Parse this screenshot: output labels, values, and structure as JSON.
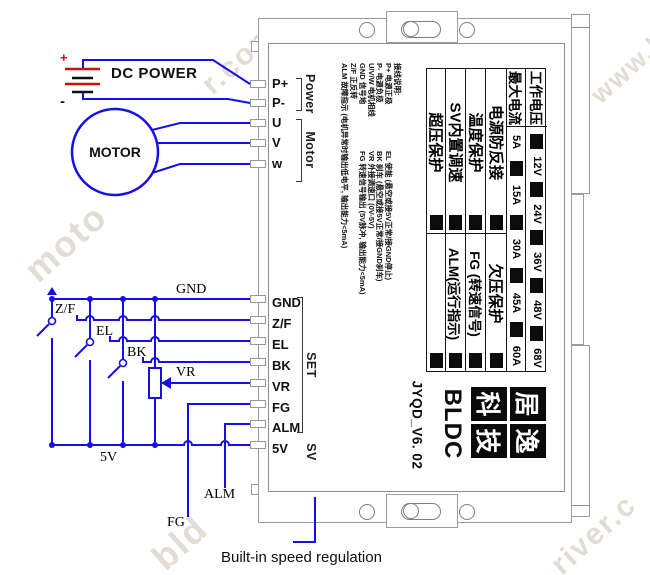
{
  "left_circuit": {
    "dc_power": "DC POWER",
    "plus": "+",
    "minus": "-",
    "motor": "MOTOR",
    "gnd": "GND",
    "five_v": "5V",
    "zf": "Z/F",
    "el": "EL",
    "bk": "BK",
    "vr": "VR",
    "fg": "FG",
    "alm": "ALM",
    "caption": "Built-in speed regulation"
  },
  "board": {
    "power_pins": [
      "P+",
      "P-",
      "U",
      "V",
      "w"
    ],
    "power_group": "Power",
    "motor_group": "Motor",
    "set_pins": [
      "GND",
      "Z/F",
      "EL",
      "BK",
      "VR",
      "FG",
      "ALM",
      "5V"
    ],
    "set_group": "SET",
    "sv_group": "SV",
    "notes": {
      "title": "接线说明:",
      "rows": [
        {
          "left": "P+ 电源正极",
          "right": "EL 使能 (悬空或接5V正常/接GND停止)"
        },
        {
          "left": "P- 电源负极",
          "right": "BK 刹车 (悬空或接5V正常/接GND刹车)"
        },
        {
          "left": "U/V/W 电机相线",
          "right": "VR 外接调速口 (0V-5V)"
        },
        {
          "left": "GND 信号地",
          "right": "FG 转速信号输出 (5V脉冲, 输出能力<5mA)"
        },
        {
          "left": "Z/F 正反转",
          "right": ""
        },
        {
          "left": "ALM 故障指示 (电机异常时输出低电平, 输出能力<5mA)",
          "right": ""
        }
      ]
    },
    "spec_table": {
      "voltage_header": "工作电压",
      "voltages": [
        "12V",
        "24V",
        "36V",
        "48V",
        "68V"
      ],
      "current_header": "最大电流",
      "currents": [
        "5A",
        "15A",
        "30A",
        "45A",
        "60A"
      ],
      "features_top": [
        "超压保护",
        "SV内置调速",
        "温度保护",
        "电源防反接"
      ],
      "features_bottom": [
        "",
        "ALM(运行指示)",
        "FG (转速信号)",
        "欠压保护"
      ]
    },
    "logo": {
      "model": "JYQD_V6. 02",
      "series": "BLDC",
      "brand": [
        "居",
        "逸",
        "科",
        "技"
      ]
    }
  },
  "colors": {
    "wire_blue": "#1511e6",
    "battery_red": "#cc1111"
  },
  "watermarks": [
    "moto",
    "r.com",
    "www.h",
    "bld",
    "river.c"
  ]
}
